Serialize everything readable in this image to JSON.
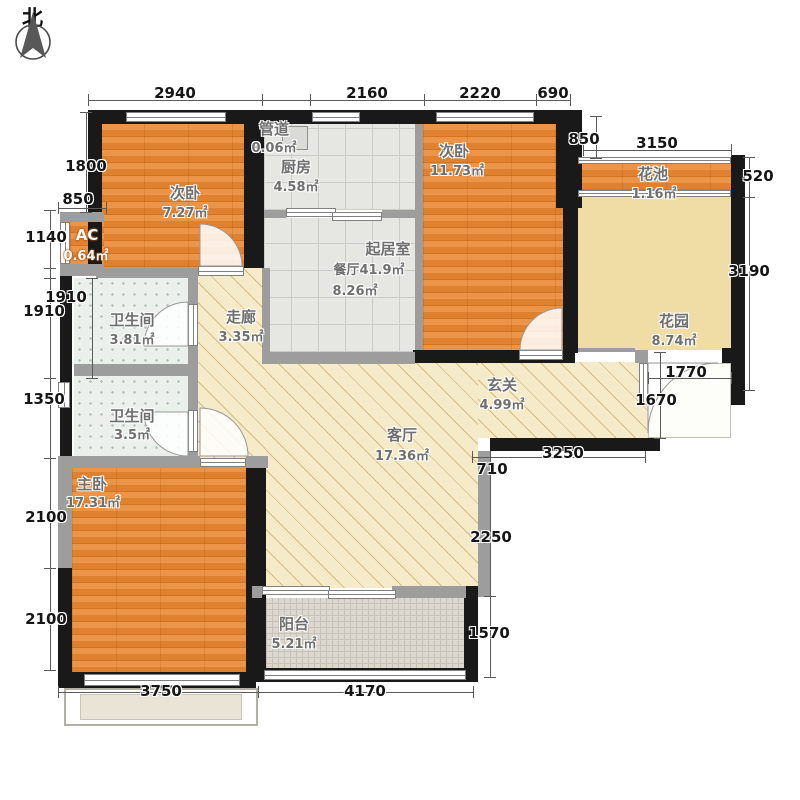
{
  "compass": {
    "label": "北"
  },
  "rooms": {
    "bed1": {
      "name": "次卧",
      "area": "7.27㎡"
    },
    "duct": {
      "name": "管道",
      "area": "0.06㎡"
    },
    "kitchen": {
      "name": "厨房",
      "area": "4.58㎡"
    },
    "livingroom": {
      "name": "起居室",
      "line2": "餐厅41.9㎡",
      "area": "8.26㎡"
    },
    "bed2": {
      "name": "次卧",
      "area": "11.73㎡"
    },
    "flowerbed": {
      "name": "花池",
      "area": "1.16㎡"
    },
    "garden": {
      "name": "花园",
      "area": "8.74㎡"
    },
    "ac": {
      "name": "AC",
      "area": "0.64㎡"
    },
    "bath1": {
      "name": "卫生间",
      "area": "3.81㎡"
    },
    "corridor": {
      "name": "走廊",
      "area": "3.35㎡"
    },
    "foyer": {
      "name": "玄关",
      "area": "4.99㎡"
    },
    "bath2": {
      "name": "卫生间",
      "area": "3.5㎡"
    },
    "master": {
      "name": "主卧",
      "area": "17.31㎡"
    },
    "living": {
      "name": "客厅",
      "area": "17.36㎡"
    },
    "balcony": {
      "name": "阳台",
      "area": "5.21㎡"
    }
  },
  "dims": {
    "top": [
      "2940",
      "2160",
      "2220",
      "690"
    ],
    "left": [
      "1800",
      "850",
      "1140",
      "1910",
      "1910",
      "1350",
      "2100",
      "2100"
    ],
    "right": [
      "850",
      "3150",
      "520",
      "3190",
      "1770",
      "1670",
      "3250",
      "710",
      "2250",
      "1570"
    ],
    "bottom": [
      "3750",
      "4170"
    ]
  },
  "colors": {
    "wall": "#191919",
    "wood": "#e0812f",
    "hatch_floor": "#f6ebc9",
    "garden": "#f0dda6"
  }
}
